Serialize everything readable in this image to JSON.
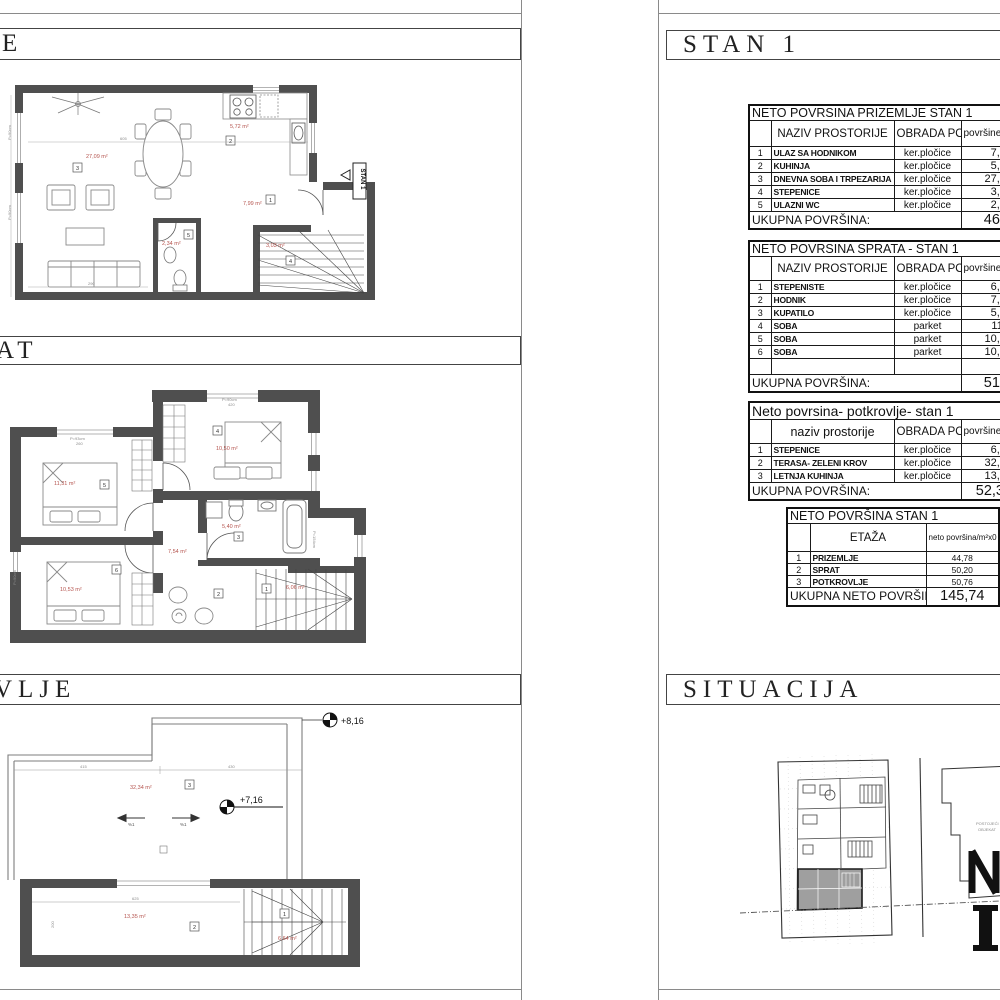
{
  "titles": {
    "left_section1": "E",
    "left_section2": "AT",
    "left_section3": "VLJE",
    "right_section1": "STAN 1",
    "right_section2": "SITUACIJA"
  },
  "tables": {
    "prizemlje": {
      "title": "NETO POVRSINA PRIZEMLJE STAN 1",
      "headers": {
        "name": "NAZIV PROSTORIJE",
        "floor": "OBRADA PODA",
        "area": "površine/m"
      },
      "rows": [
        {
          "num": "1",
          "name": "ULAZ SA HODNIKOM",
          "floor": "ker.pločice",
          "area": "7,99"
        },
        {
          "num": "2",
          "name": "KUHINJA",
          "floor": "ker.pločice",
          "area": "5,72"
        },
        {
          "num": "3",
          "name": "DNEVNA SOBA I TRPEZARIJA",
          "floor": "ker.pločice",
          "area": "27,09"
        },
        {
          "num": "4",
          "name": "STEPENICE",
          "floor": "ker.pločice",
          "area": "3,03"
        },
        {
          "num": "5",
          "name": "ULAZNI WC",
          "floor": "ker.pločice",
          "area": "2,34"
        }
      ],
      "total_label": "UKUPNA POVRŠINA:",
      "total": "46,1"
    },
    "sprat": {
      "title": "NETO POVRSINA SPRATA - STAN 1",
      "headers": {
        "name": "NAZIV PROSTORIJE",
        "floor": "OBRADA PODA",
        "area": "površine/m"
      },
      "rows": [
        {
          "num": "1",
          "name": "STEPENISTE",
          "floor": "ker.pločice",
          "area": "6,06"
        },
        {
          "num": "2",
          "name": "HODNIK",
          "floor": "ker.pločice",
          "area": "7,54"
        },
        {
          "num": "3",
          "name": "KUPATILO",
          "floor": "ker.pločice",
          "area": "5,40"
        },
        {
          "num": "4",
          "name": "SOBA",
          "floor": "parket",
          "area": "11,3"
        },
        {
          "num": "5",
          "name": "SOBA",
          "floor": "parket",
          "area": "10,53"
        },
        {
          "num": "6",
          "name": "SOBA",
          "floor": "parket",
          "area": "10,92"
        }
      ],
      "total_label": "UKUPNA POVRŠINA:",
      "total": "51,7"
    },
    "potkrovlje": {
      "title": "Neto povrsina- potkrovlje- stan 1",
      "headers": {
        "name": "naziv prostorije",
        "floor": "OBRADA PODA",
        "area": "površine"
      },
      "rows": [
        {
          "num": "1",
          "name": "STEPENICE",
          "floor": "ker.pločice",
          "area": "6,64"
        },
        {
          "num": "2",
          "name": "TERASA- ZELENI KROV",
          "floor": "ker.pločice",
          "area": "32,34"
        },
        {
          "num": "3",
          "name": "LETNJA KUHINJA",
          "floor": "ker.pločice",
          "area": "13,35"
        }
      ],
      "total_label": "UKUPNA POVRŠINA:",
      "total": "52,33"
    },
    "summary": {
      "title": "NETO POVRŠINA STAN 1",
      "headers": {
        "etaza": "ETAŽA",
        "value": "neto površina/m²x0"
      },
      "rows": [
        {
          "num": "1",
          "name": "PRIZEMLJE",
          "value": "44,78"
        },
        {
          "num": "2",
          "name": "SPRAT",
          "value": "50,20"
        },
        {
          "num": "3",
          "name": "POTKROVLJE",
          "value": "50,76"
        }
      ],
      "total_label": "UKUPNA NETO POVRŠINA:",
      "total": "145,74"
    }
  },
  "plans": {
    "prizemlje": {
      "area_living": "27,09 m²",
      "area_kitchen": "5,72 m²",
      "area_hall": "7,99 m²",
      "area_wc": "2,34 m²",
      "area_stairs": "3,03 m²",
      "room_living": "3",
      "room_kitchen": "2",
      "room_hall": "1",
      "room_stairs": "4",
      "room_wc": "5",
      "entry_label": "STAN 1",
      "dim_top": "605",
      "dim_bottom": "290",
      "parapet_left1": "P=90cm",
      "parapet_left2": "P=90cm"
    },
    "sprat": {
      "area_room1": "11,31 m²",
      "area_room2": "10,50 m²",
      "area_room3": "10,53 m²",
      "area_bath": "5,40 m²",
      "area_hall": "7,54 m²",
      "area_stairs": "6,06 m²",
      "room_stairs": "1",
      "room_hall": "2",
      "room_bath": "3",
      "room_bed1": "4",
      "room_bed2": "5",
      "room_bed3": "6",
      "parapet_top_left": "P=93cm",
      "parapet_top_right": "P=90cm",
      "parapet_left": "P=90cm",
      "parapet_right": "P=154cm",
      "dim_top_left": "260",
      "dim_top_right": "420"
    },
    "potkrovlje": {
      "elev_high": "+8,16",
      "elev_low": "+7,16",
      "area_terrace": "32,34 m²",
      "area_kitchen": "13,35 m²",
      "area_stairs": "6,64 m²",
      "slope_left": "%1",
      "slope_right": "%1",
      "room_terrace": "3",
      "room_kitchen": "2",
      "room_stairs": "1",
      "dim_left": "415",
      "dim_right": "430",
      "dim_bottom": "625",
      "dim_side": "200"
    },
    "situacija": {
      "note_line1": "POSTOJEĆI",
      "note_line2": "OBJEKAT"
    }
  }
}
